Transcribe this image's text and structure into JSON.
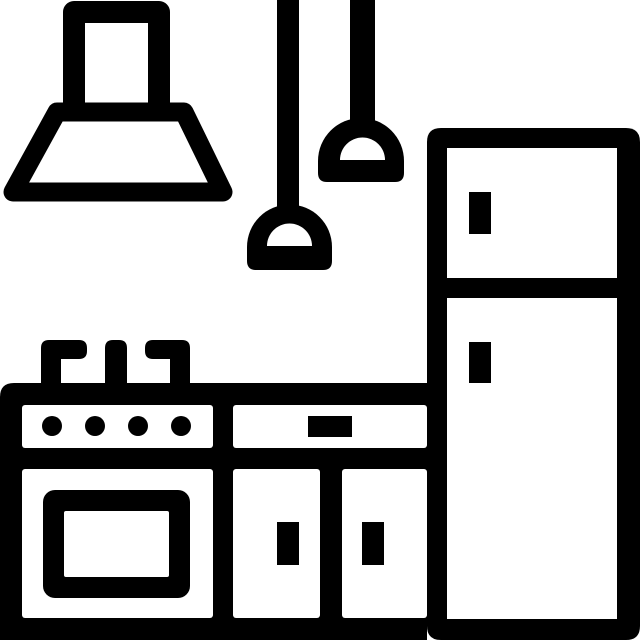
{
  "canvas": {
    "width": 640,
    "height": 640,
    "background": "#ffffff"
  },
  "colors": {
    "ink": "#000000",
    "paper": "#ffffff"
  },
  "icon": {
    "title": "Kitchen line icon",
    "components": [
      {
        "id": "range-hood",
        "label": "range hood with chimney"
      },
      {
        "id": "pendant-lamp-left",
        "label": "hanging pendant lamp"
      },
      {
        "id": "pendant-lamp-right",
        "label": "hanging pendant lamp"
      },
      {
        "id": "refrigerator",
        "label": "two-door refrigerator with handles"
      },
      {
        "id": "stove-oven",
        "label": "stove with four knobs, burner grates and oven door"
      },
      {
        "id": "cabinets",
        "label": "counter cabinets with drawer and two doors"
      }
    ]
  }
}
